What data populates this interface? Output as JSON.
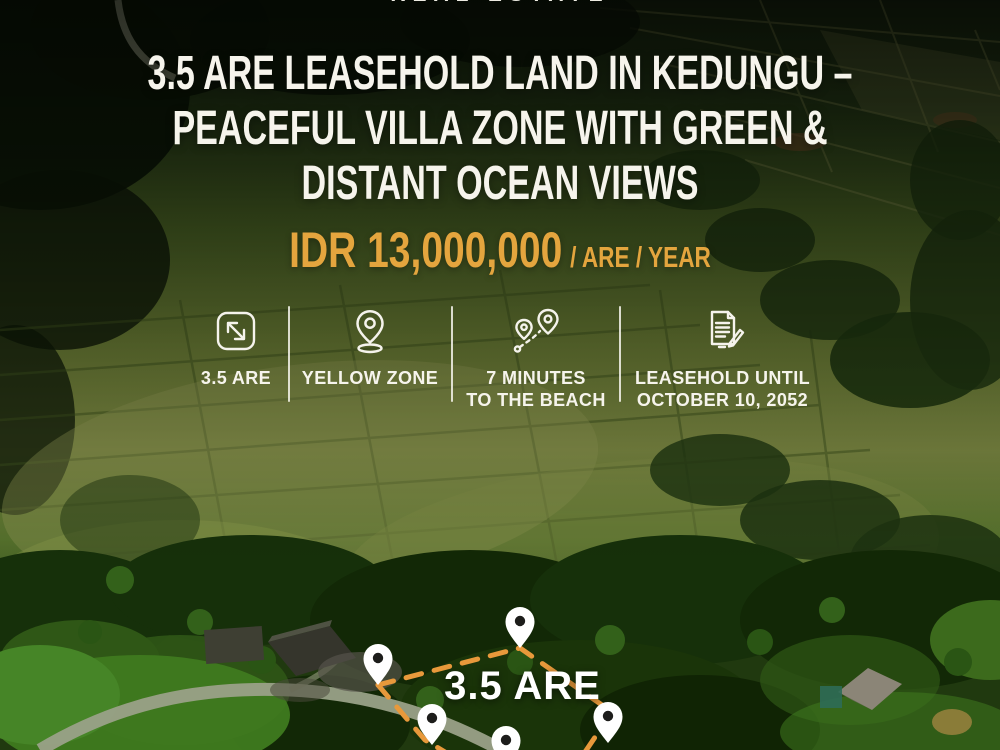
{
  "brand_top": {
    "text": "REAL ESTATE"
  },
  "title": {
    "text": "3.5 ARE LEASEHOLD LAND IN KEDUNGU –\nPEACEFUL VILLA ZONE WITH GREEN &\nDISTANT OCEAN VIEWS"
  },
  "price": {
    "amount": "IDR 13,000,000",
    "unit": "/ ARE / YEAR"
  },
  "features": [
    {
      "icon": "area-expand-icon",
      "label": "3.5 ARE"
    },
    {
      "icon": "location-pin-icon",
      "label": "YELLOW ZONE"
    },
    {
      "icon": "route-distance-icon",
      "label": "7 MINUTES\nTO THE BEACH"
    },
    {
      "icon": "leasehold-document-icon",
      "label": "LEASEHOLD UNTIL\nOCTOBER 10, 2052"
    }
  ],
  "plot_marker": {
    "label": "3.5 ARE",
    "pin_count": 5
  },
  "colors": {
    "accent_gold": "#E4A53E",
    "dash_orange": "#E8993B",
    "text_white": "#F6F4EC"
  }
}
